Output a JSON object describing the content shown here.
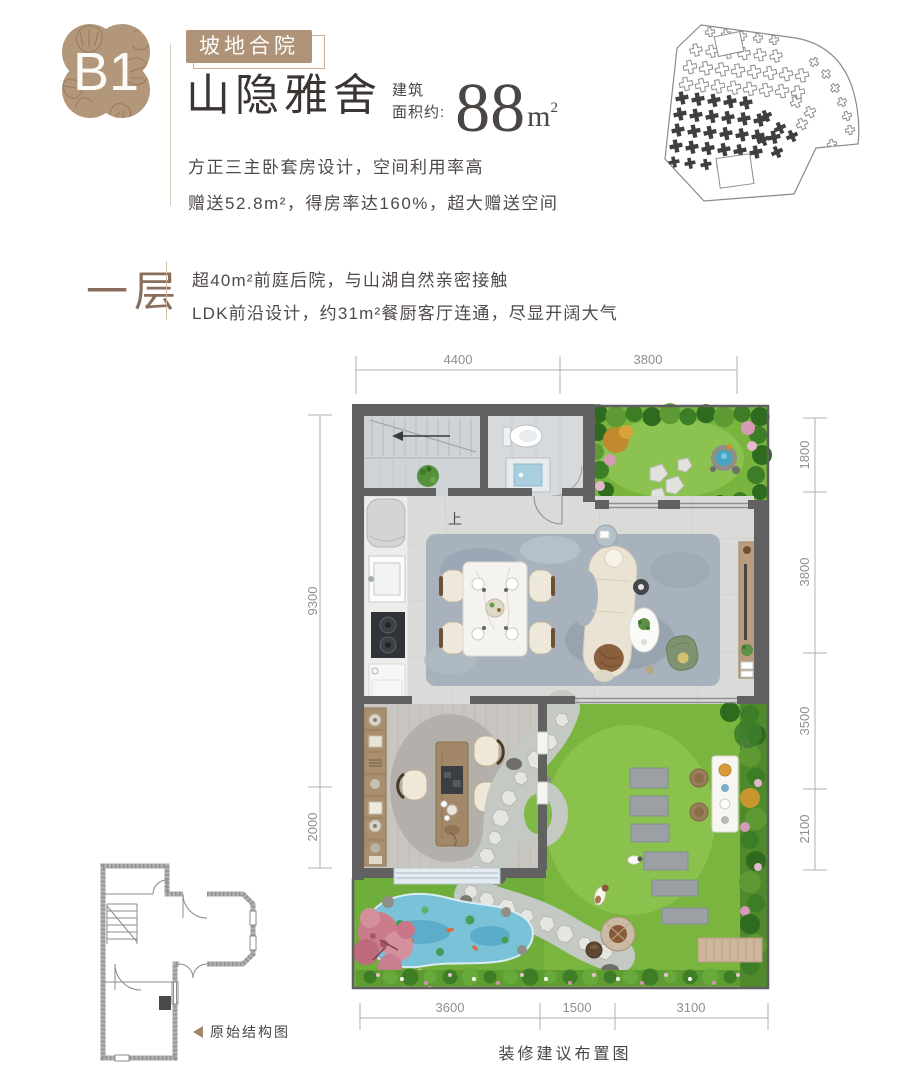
{
  "header": {
    "badge": "B1",
    "tag": "坡地合院",
    "title": "山隐雅舍",
    "area_label_line1": "建筑",
    "area_label_line2": "面积约:",
    "area_value": "88",
    "area_unit": "m",
    "area_unit_exp": "2",
    "desc_line1": "方正三主卧套房设计，空间利用率高",
    "desc_line2": "赠送52.8m²，得房率达160%，超大赠送空间"
  },
  "floor_section": {
    "label": "一层",
    "feature_line1": "超40m²前庭后院，与山湖自然亲密接触",
    "feature_line2": "LDK前沿设计，约31m²餐厨客厅连通，尽显开阔大气"
  },
  "floor_plan": {
    "stair_label": "上",
    "caption": "装修建议布置图",
    "dims_top": [
      "4400",
      "3800"
    ],
    "dims_right": [
      "1800",
      "3800",
      "3500",
      "2100"
    ],
    "dims_left": [
      "9300",
      "2000"
    ],
    "dims_bottom": [
      "3600",
      "1500",
      "3100"
    ]
  },
  "structure_diagram": {
    "caption": "原始结构图"
  },
  "colors": {
    "accent_tan": "#ae9378",
    "title_brown": "#8a6e5b",
    "wall_gray": "#616161",
    "lawn_green": "#7ab63f",
    "pond_blue": "#79c2d8"
  }
}
